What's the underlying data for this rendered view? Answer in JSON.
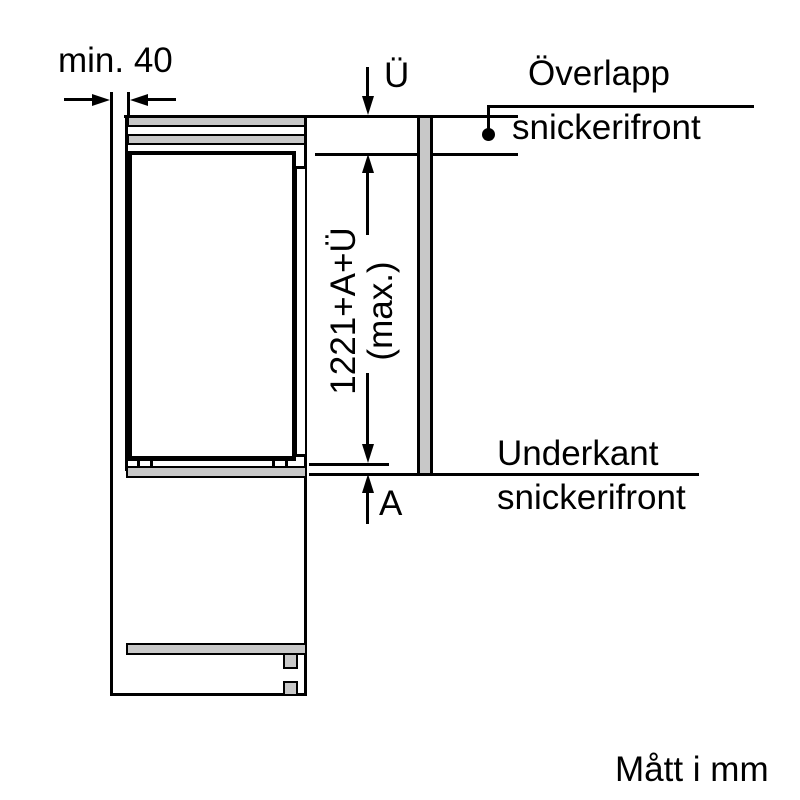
{
  "diagram": {
    "title_note": "Mått i mm",
    "labels": {
      "min_gap": "min. 40",
      "overlap_dim": "Ü",
      "overlap_callout_line1": "Överlapp",
      "overlap_callout_line2": "snickerifront",
      "panel_height_line1": "1221+A+Ü",
      "panel_height_line2": "(max.)",
      "bottom_dim": "A",
      "bottom_edge_callout_line1": "Underkant",
      "bottom_edge_callout_line2": "snickerifront"
    },
    "colors": {
      "line": "#000000",
      "panel_fill": "#c8c8c8",
      "background": "#ffffff"
    }
  }
}
